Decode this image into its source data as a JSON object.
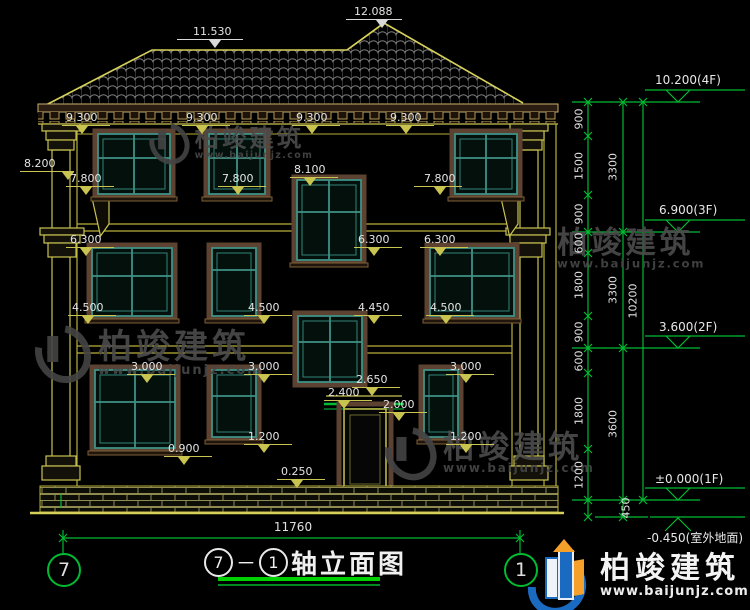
{
  "title": {
    "axis_start": "7",
    "separator": "－",
    "axis_end": "1",
    "text": "轴立面图"
  },
  "grid_bubbles": {
    "left": "7",
    "right": "1"
  },
  "bottom_dim": "11760",
  "markers": [
    {
      "text": "12.088",
      "x": 354,
      "y": 6,
      "variant": "roof",
      "lw": 56,
      "lx": -8,
      "tx": 22
    },
    {
      "text": "11.530",
      "x": 193,
      "y": 26,
      "variant": "roof",
      "lw": 66,
      "lx": -16,
      "tx": 16
    },
    {
      "text": "9.300",
      "x": 66,
      "y": 112
    },
    {
      "text": "9.300",
      "x": 186,
      "y": 112
    },
    {
      "text": "9.300",
      "x": 296,
      "y": 112
    },
    {
      "text": "9.300",
      "x": 390,
      "y": 112
    },
    {
      "text": "8.200",
      "x": 24,
      "y": 158,
      "lw": 54,
      "tx": 38
    },
    {
      "text": "7.800",
      "x": 70,
      "y": 173
    },
    {
      "text": "7.800",
      "x": 222,
      "y": 173
    },
    {
      "text": "8.100",
      "x": 294,
      "y": 164
    },
    {
      "text": "7.800",
      "x": 424,
      "y": 173,
      "lx": -10
    },
    {
      "text": "6.300",
      "x": 70,
      "y": 234
    },
    {
      "text": "6.300",
      "x": 358,
      "y": 234
    },
    {
      "text": "6.300",
      "x": 424,
      "y": 234
    },
    {
      "text": "4.500",
      "x": 72,
      "y": 302
    },
    {
      "text": "4.500",
      "x": 248,
      "y": 302
    },
    {
      "text": "4.450",
      "x": 358,
      "y": 302
    },
    {
      "text": "4.500",
      "x": 430,
      "y": 302
    },
    {
      "text": "3.000",
      "x": 131,
      "y": 361
    },
    {
      "text": "3.000",
      "x": 248,
      "y": 361
    },
    {
      "text": "2.650",
      "x": 356,
      "y": 374
    },
    {
      "text": "2.400",
      "x": 328,
      "y": 387
    },
    {
      "text": "2.000",
      "x": 383,
      "y": 399
    },
    {
      "text": "3.000",
      "x": 450,
      "y": 361
    },
    {
      "text": "0.900",
      "x": 168,
      "y": 443
    },
    {
      "text": "1.200",
      "x": 248,
      "y": 431
    },
    {
      "text": "0.250",
      "x": 281,
      "y": 466
    },
    {
      "text": "1.200",
      "x": 450,
      "y": 431
    }
  ],
  "floor_markers": [
    {
      "text": "10.200(4F)",
      "x": 655,
      "y": 74
    },
    {
      "text": "6.900(3F)",
      "x": 659,
      "y": 204
    },
    {
      "text": "3.600(2F)",
      "x": 659,
      "y": 321
    },
    {
      "text": "±0.000(1F)",
      "x": 655,
      "y": 473
    },
    {
      "text": "-0.450(室外地面)",
      "x": 647,
      "y": 532
    }
  ],
  "dim_numbers": [
    {
      "text": "900",
      "x": 579,
      "y": 119
    },
    {
      "text": "1500",
      "x": 579,
      "y": 166
    },
    {
      "text": "900",
      "x": 579,
      "y": 214
    },
    {
      "text": "3300",
      "x": 613,
      "y": 167
    },
    {
      "text": "600",
      "x": 579,
      "y": 243
    },
    {
      "text": "1800",
      "x": 579,
      "y": 285
    },
    {
      "text": "900",
      "x": 579,
      "y": 332
    },
    {
      "text": "3300",
      "x": 613,
      "y": 290
    },
    {
      "text": "10200",
      "x": 633,
      "y": 301
    },
    {
      "text": "600",
      "x": 579,
      "y": 361
    },
    {
      "text": "1800",
      "x": 579,
      "y": 411
    },
    {
      "text": "1200",
      "x": 579,
      "y": 475
    },
    {
      "text": "3600",
      "x": 613,
      "y": 424
    },
    {
      "text": "450",
      "x": 626,
      "y": 508
    }
  ],
  "watermark": {
    "name": "柏竣建筑",
    "site": "www.baijunjz.com",
    "positions": [
      {
        "x": 150,
        "y": 122,
        "scale": 0.72
      },
      {
        "x": 36,
        "y": 324,
        "scale": 1.0
      },
      {
        "x": 557,
        "y": 228,
        "scale": 0.9,
        "no_logo": true
      },
      {
        "x": 386,
        "y": 426,
        "scale": 0.92
      }
    ]
  },
  "logo": {
    "name": "柏竣建筑",
    "site": "www.baijunjz.com"
  },
  "colors": {
    "facade_line": "#c9c34f",
    "roof_outline": "#d6d05a",
    "window_frame": "#3f9186",
    "window_surround": "#5d4231",
    "dimension_green": "#00bb33",
    "title_underline": "#00cf00",
    "logo_blue": "#1b6ac2",
    "logo_orange": "#f5a02b"
  }
}
